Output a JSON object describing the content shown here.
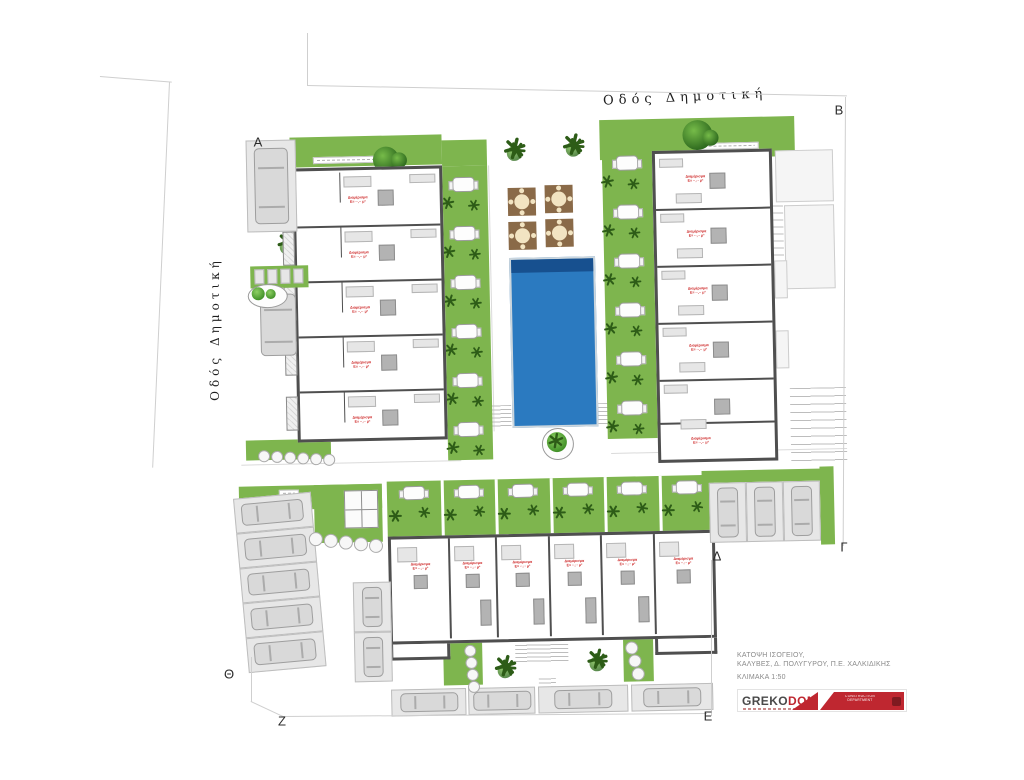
{
  "streets": {
    "top": "Οδός Δημοτική",
    "left": "Οδός Δημοτική"
  },
  "vertices": [
    "Α",
    "Β",
    "Γ",
    "Δ",
    "Ε",
    "Ζ",
    "Θ"
  ],
  "apartment_label": {
    "line1": "Διαμέρισμα",
    "line2": "Ε= ··,·· μ²"
  },
  "buildings": {
    "left_units": 5,
    "right_units": 5,
    "bottom_units": 6
  },
  "gardens": {
    "left_tables": 6,
    "right_tables": 6,
    "bottom_tables": 6
  },
  "courtyard": {
    "parasol_decks": 4,
    "pool": true
  },
  "parking": {
    "left_diagonal_stalls": 5,
    "bottom_stalls": 4,
    "right_stalls": 3,
    "side_column_stalls": 2
  },
  "title_block": {
    "line1": "ΚΑΤΟΨΗ ΙΣΟΓΕΙΟΥ,",
    "line2": "ΚΑΛΥΒΕΣ, Δ. ΠΟΛΥΓΥΡΟΥ, Π.Ε. ΧΑΛΚΙΔΙΚΗΣ",
    "line3": "ΚΛΙΜΑΚΑ 1:50"
  },
  "logo": {
    "brand_prefix": "GREKO",
    "brand_suffix": "DOM",
    "banner_line1": "CONSTRUCTION",
    "banner_line2": "DEPARTMENT"
  },
  "colors": {
    "grass": "#7eb54e",
    "grass_light": "#a8cf7d",
    "plant": "#2d5c17",
    "pool": "#2b7ac0",
    "pool_deep": "#17508f",
    "deck_brown": "#8a6a48",
    "wall": "#4f4f4f",
    "label_red": "#cc2222",
    "logo_red": "#bf2730"
  }
}
